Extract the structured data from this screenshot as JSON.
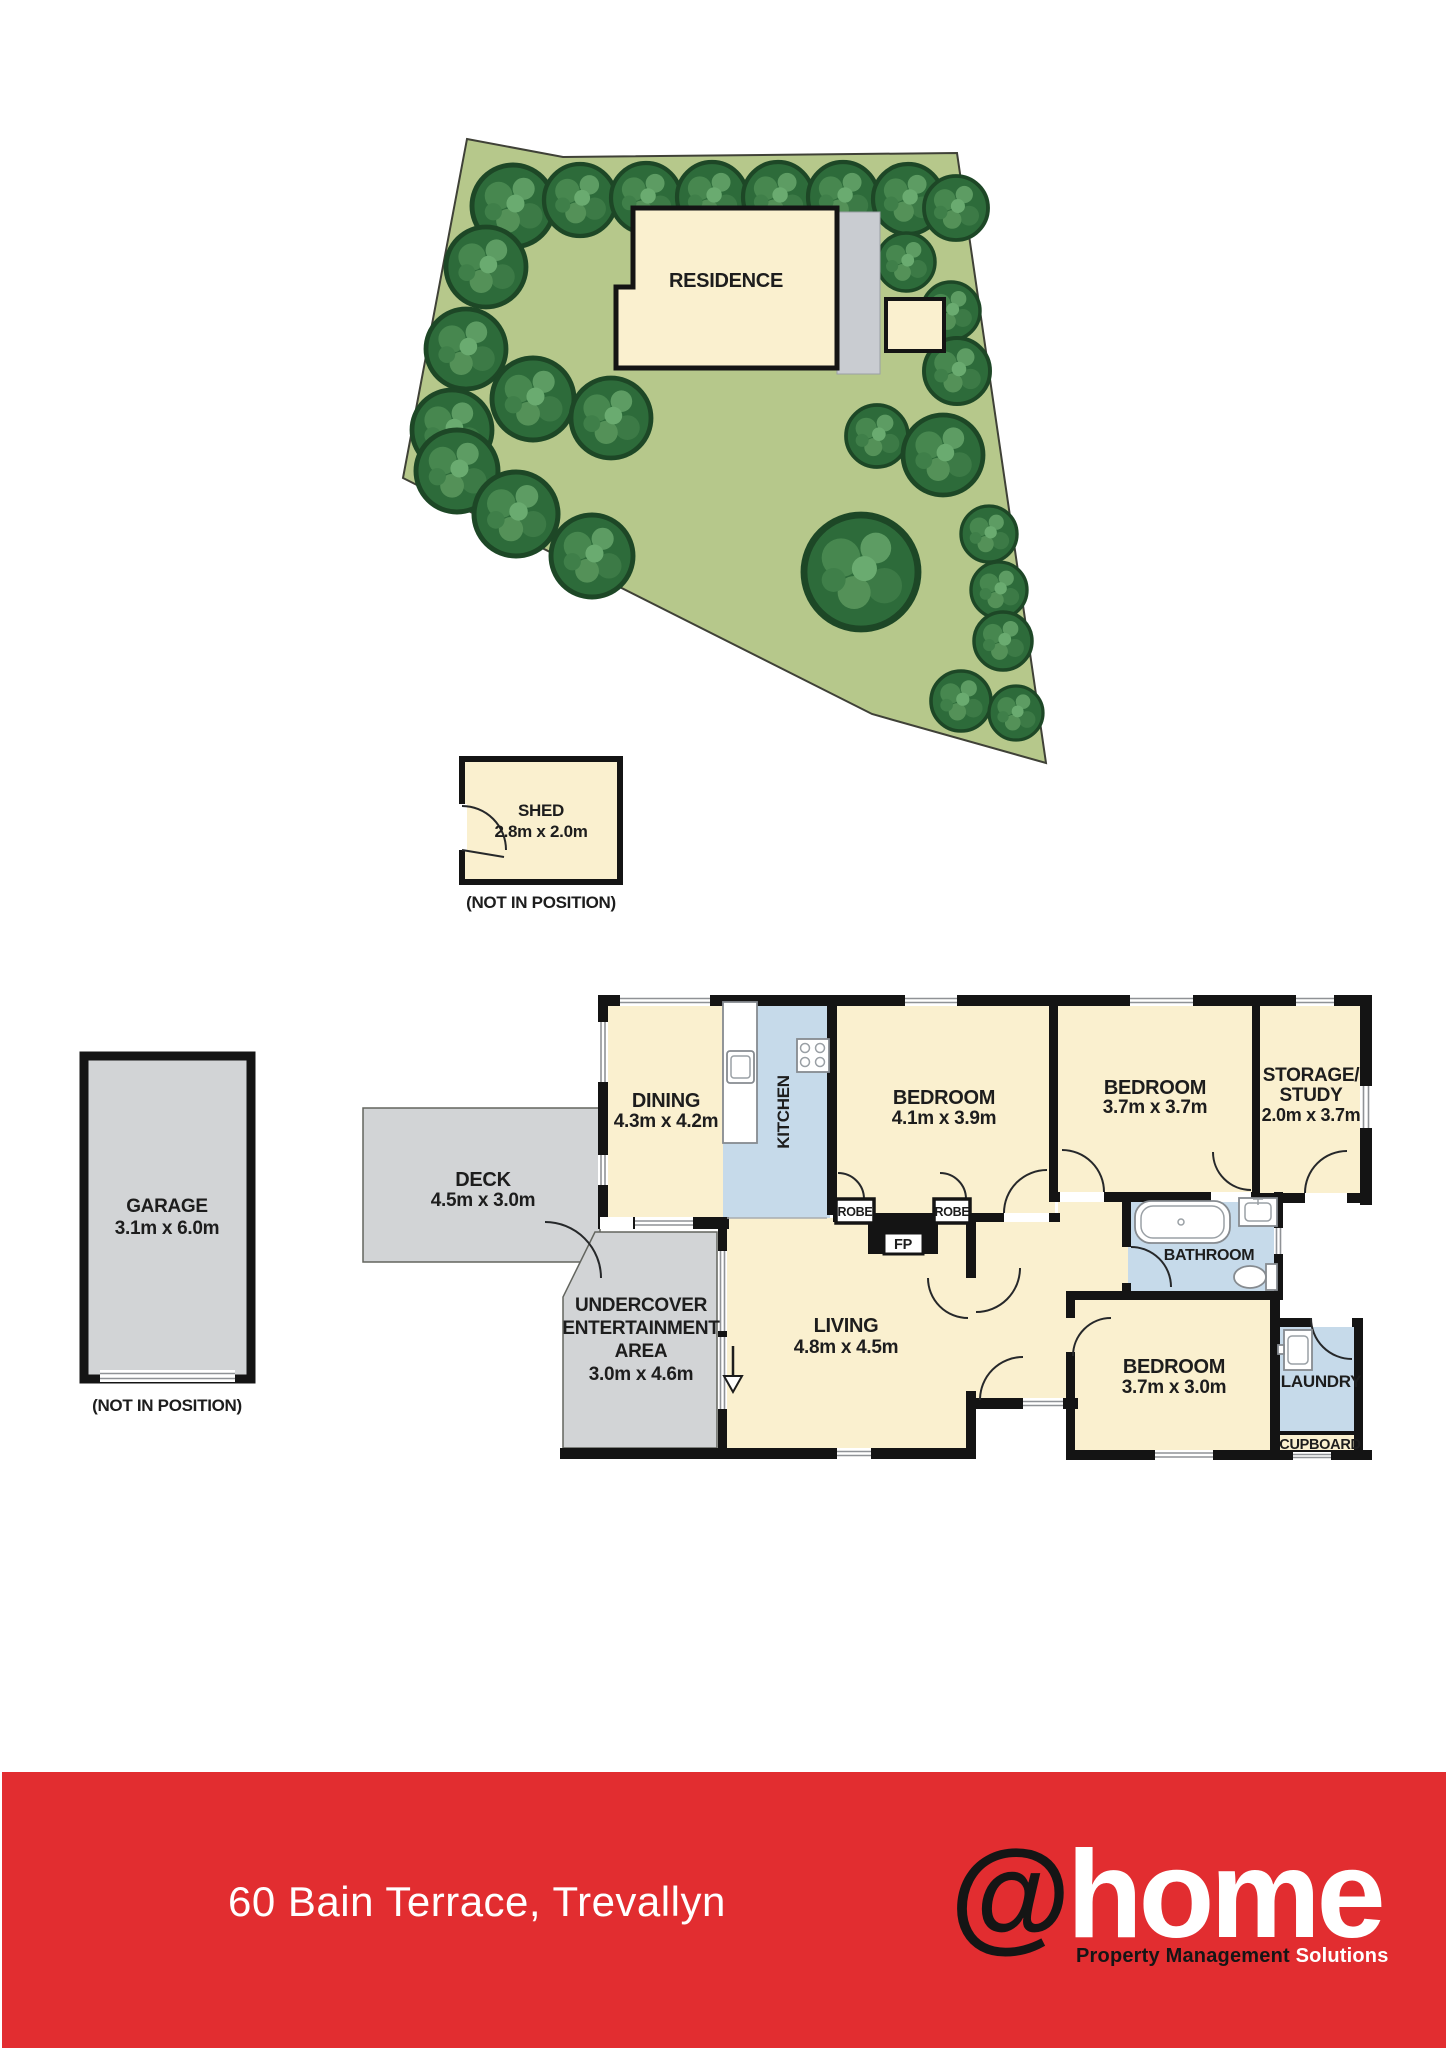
{
  "colors": {
    "banner_red": "#e22d30",
    "lot_green": "#b6c88b",
    "tree_green": "#2d6b3a",
    "floor_cream": "#faf0cf",
    "wet_area_blue": "#c6daea",
    "deck_gray": "#d2d4d6",
    "wall_black": "#141414"
  },
  "site_plan": {
    "residence": "RESIDENCE"
  },
  "shed": {
    "name": "SHED",
    "dims": "2.8m x 2.0m",
    "note": "(NOT IN POSITION)"
  },
  "garage": {
    "name": "GARAGE",
    "dims": "3.1m x 6.0m",
    "note": "(NOT IN POSITION)"
  },
  "rooms": {
    "dining": {
      "name": "DINING",
      "dims": "4.3m x 4.2m"
    },
    "kitchen": {
      "name": "KITCHEN"
    },
    "bedroom1": {
      "name": "BEDROOM",
      "dims": "4.1m x 3.9m"
    },
    "bedroom2": {
      "name": "BEDROOM",
      "dims": "3.7m x 3.7m"
    },
    "storage_study": {
      "name_line1": "STORAGE/",
      "name_line2": "STUDY",
      "dims": "2.0m x 3.7m"
    },
    "deck": {
      "name": "DECK",
      "dims": "4.5m x 3.0m"
    },
    "undercover": {
      "name_line1": "UNDERCOVER",
      "name_line2": "ENTERTAINMENT",
      "name_line3": "AREA",
      "dims": "3.0m x 4.6m"
    },
    "living": {
      "name": "LIVING",
      "dims": "4.8m x 4.5m"
    },
    "bathroom": {
      "name": "BATHROOM"
    },
    "bedroom3": {
      "name": "BEDROOM",
      "dims": "3.7m x 3.0m"
    },
    "laundry": {
      "name": "LAUNDRY"
    },
    "cupboard": {
      "name": "CUPBOARD"
    },
    "robe_left": "ROBE",
    "robe_right": "ROBE",
    "fireplace": "FP"
  },
  "footer": {
    "address": "60 Bain Terrace, Trevallyn",
    "logo_at": "@",
    "logo_home": "home",
    "tagline_dark": "Property Management ",
    "tagline_light": "Solutions"
  }
}
